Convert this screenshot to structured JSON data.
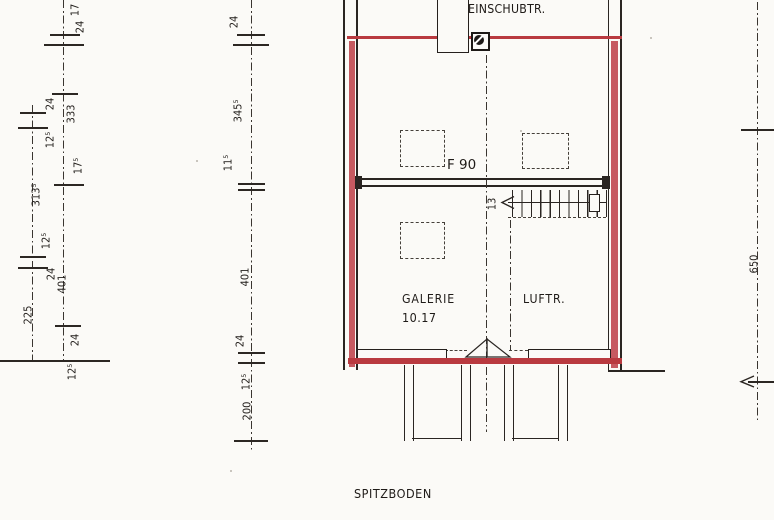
{
  "palette": {
    "paper": "#fbfaf7",
    "ink": "#272220",
    "red_line": "#b93a40",
    "red_fill": "#c65a61",
    "red_handwriting": "#c93b44"
  },
  "plan": {
    "top_label": "EINSCHUBTR.",
    "fire_rating_label": "F 90",
    "room_name": "GALERIE",
    "room_area": "10.17",
    "void_label": "LUFTR.",
    "stair_riser_count": "13"
  },
  "dims": {
    "left": [
      "17",
      "24",
      "24",
      "333",
      "12⁵",
      "17⁵",
      "313⁵",
      "12⁵",
      "24",
      "401",
      "225",
      "24",
      "12⁵"
    ],
    "middle": [
      "24",
      "345⁵",
      "11⁵",
      "401",
      "24",
      "12⁵",
      "200"
    ],
    "right": [
      "650"
    ]
  },
  "footer": {
    "title": "SPITZBODEN",
    "handwritten_annotation": "GALERIE"
  }
}
